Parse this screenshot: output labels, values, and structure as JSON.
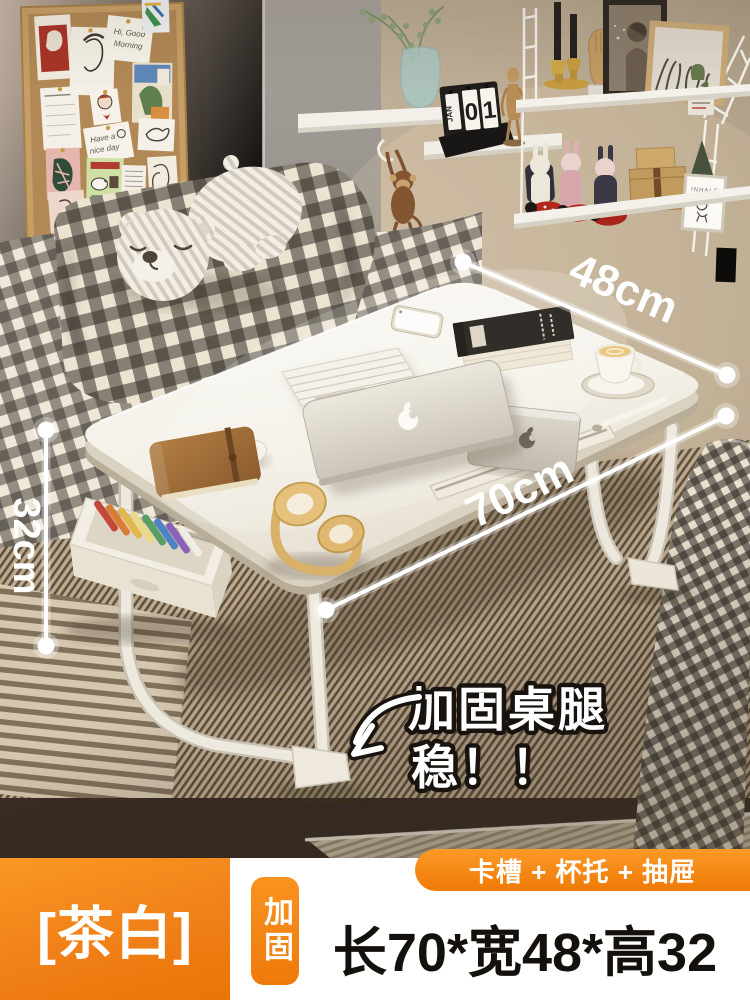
{
  "photo": {
    "dimensions": {
      "width_label": "48cm",
      "length_label": "70cm",
      "height_label": "32cm"
    },
    "callout": {
      "line1": "加固桌腿",
      "line2": "稳！！"
    },
    "shelf": {
      "calendar_month": "JAN",
      "calendar_digit1": "0",
      "calendar_digit2": "1",
      "frame_label": "INHALE"
    },
    "pinboard": {
      "note1_line1": "Hi, Good",
      "note1_line2": "Morning",
      "note2_line1": "Have a",
      "note2_line2": "nice day"
    }
  },
  "banner": {
    "color_name": "[茶白]",
    "badge_label": "加固",
    "features_ribbon": "卡槽 + 杯托 + 抽屉",
    "size_text": "长70*宽48*高32"
  },
  "colors": {
    "accent_orange": "#f08018",
    "orange_light": "#fa9826",
    "orange_dark": "#ea7406",
    "size_text_color": "#14100c"
  }
}
